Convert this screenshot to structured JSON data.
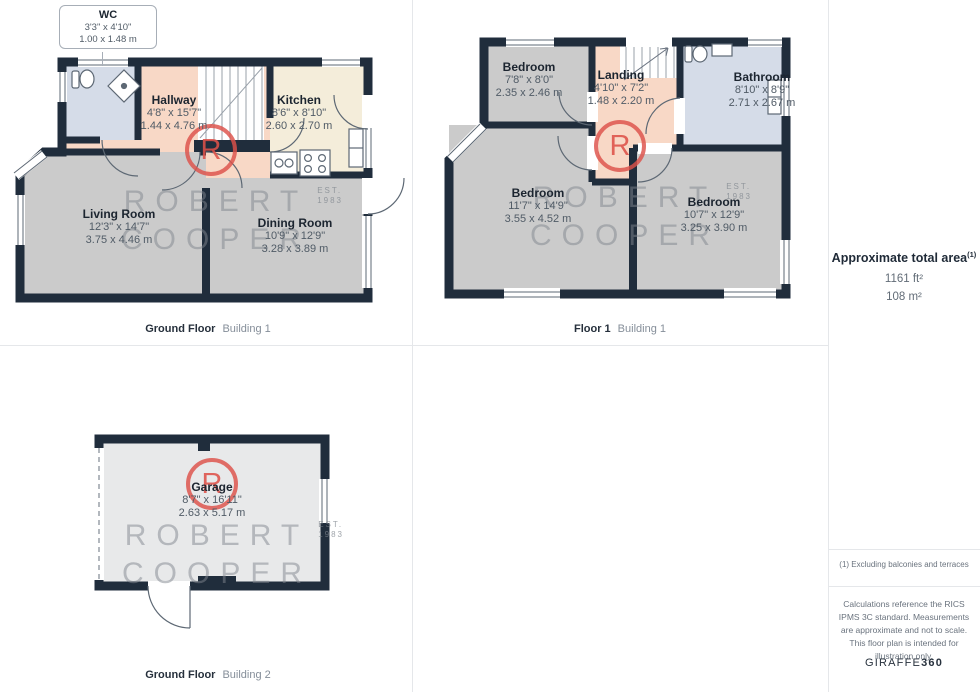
{
  "panels": {
    "gf1": {
      "caption_bold": "Ground Floor",
      "caption_regular": "Building 1",
      "rooms": [
        {
          "name": "WC",
          "imperial": "3'3\" x 4'10\"",
          "metric": "1.00 x 1.48 m"
        },
        {
          "name": "Hallway",
          "imperial": "4'8\" x 15'7\"",
          "metric": "1.44 x 4.76 m"
        },
        {
          "name": "Kitchen",
          "imperial": "8'6\" x 8'10\"",
          "metric": "2.60 x 2.70 m"
        },
        {
          "name": "Living Room",
          "imperial": "12'3\" x 14'7\"",
          "metric": "3.75 x 4.46 m"
        },
        {
          "name": "Dining Room",
          "imperial": "10'9\" x 12'9\"",
          "metric": "3.28 x 3.89 m"
        }
      ]
    },
    "f1": {
      "caption_bold": "Floor 1",
      "caption_regular": "Building 1",
      "rooms": [
        {
          "name": "Bedroom",
          "imperial": "7'8\" x 8'0\"",
          "metric": "2.35 x 2.46 m"
        },
        {
          "name": "Landing",
          "imperial": "4'10\" x 7'2\"",
          "metric": "1.48 x 2.20 m"
        },
        {
          "name": "Bathroom",
          "imperial": "8'10\" x 8'9\"",
          "metric": "2.71 x 2.67 m"
        },
        {
          "name": "Bedroom",
          "imperial": "11'7\" x 14'9\"",
          "metric": "3.55 x 4.52 m"
        },
        {
          "name": "Bedroom",
          "imperial": "10'7\" x 12'9\"",
          "metric": "3.25 x 3.90 m"
        }
      ]
    },
    "gf2": {
      "caption_bold": "Ground Floor",
      "caption_regular": "Building 2",
      "rooms": [
        {
          "name": "Garage",
          "imperial": "8'7\" x 16'11\"",
          "metric": "2.63 x 5.17 m"
        }
      ]
    }
  },
  "sidebar": {
    "total_area_label": "Approximate total area",
    "total_area_sup": "(1)",
    "total_area_ft": "1161 ft²",
    "total_area_m": "108 m²",
    "footnote": "(1) Excluding balconies and terraces",
    "legal": "Calculations reference the RICS IPMS 3C standard. Measurements are approximate and not to scale. This floor plan is intended for illustration only.",
    "brand_regular": "GIRAFFE",
    "brand_bold": "360"
  },
  "watermark": {
    "logo_letter": "R",
    "line1": "ROBERT",
    "line2": "COOPER",
    "est1": "EST.",
    "est2": "1983"
  },
  "colors": {
    "wall": "#202d3c",
    "hall": "#f8d8c6",
    "kitchen": "#f4edda",
    "room_gray": "#cbcbcb",
    "bath_blue": "#d5dce8",
    "garage_gray": "#e8e9ea",
    "logo_red": "#dd5149"
  }
}
